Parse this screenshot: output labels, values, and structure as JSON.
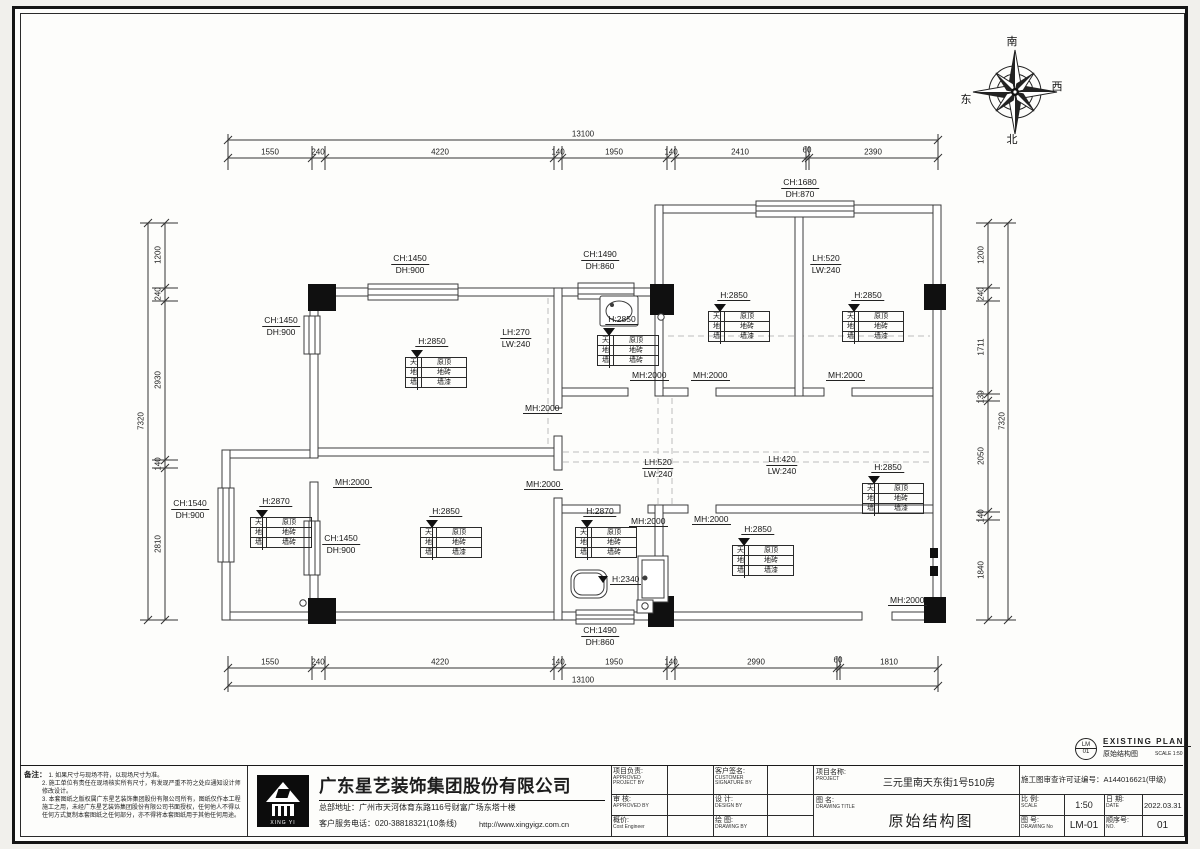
{
  "compass": {
    "south": "南",
    "west": "西",
    "east": "东",
    "north": "北"
  },
  "stamp": {
    "code_top": "LM",
    "code_bottom": "01",
    "title_en": "EXISTING PLAN",
    "title_cn": "原始结构图",
    "scale": "SCALE 1:50"
  },
  "notes": {
    "label": "备注：",
    "items": [
      "1. 如果尺寸与现场不符，以现场尺寸为准。",
      "2. 施工单位有责任在现场核实所有尺寸，有发现严重不符之处应通知设计师修改设计。",
      "3. 本套图纸之版权属广东星艺装饰集团股份有限公司所有，图纸仅作本工程施工之用，未经广东星艺装饰集团股份有限公司书面授权，任何他人不得以任何方式复制本套图纸之任何部分，亦不得将本套图纸用于其他任何用途。"
    ]
  },
  "company": {
    "name": "广东星艺装饰集团股份有限公司",
    "address": "总部地址：广州市天河体育东路116号财富广场东塔十楼",
    "tel": "客户服务电话：020-38818321(10条线)",
    "url": "http://www.xingyigz.com.cn",
    "logo_label": "XING YI"
  },
  "titleblock": {
    "pm_cn": "项目负责:",
    "pm_en": "APPROVED PROJECT BY",
    "customer_cn": "客户签名:",
    "customer_en": "CUSTOMER SIGNATURE BY",
    "check_cn": "审 核:",
    "check_en": "APPROVED BY",
    "design_cn": "设 计:",
    "design_en": "DESIGN BY",
    "cost_cn": "概价:",
    "cost_en": "Cost Engineer",
    "draw_cn": "绘 图:",
    "draw_en": "DRAWING BY",
    "project_cn": "项目名称:",
    "project_en": "PROJECT",
    "project_value": "三元里南天东街1号510房",
    "license": "施工图审查许可证编号：A144016621(甲级)",
    "title_cn": "图 名:",
    "title_en": "DRAWING  TITLE",
    "title_value": "原始结构图",
    "scale_cn": "比 例:",
    "scale_en": "SCALE",
    "scale_value": "1:50",
    "date_cn": "日 期:",
    "date_en": "DATE",
    "date_value": "2022.03.31",
    "drawno_cn": "图 号:",
    "drawno_en": "DRAWING No",
    "drawno_value": "LM-01",
    "seq_cn": "顺序号:",
    "seq_en": "NO.",
    "seq_value": "01"
  },
  "plan": {
    "dim_labels": [
      {
        "t": "13100",
        "x": 583,
        "y": 134,
        "r": 0
      },
      {
        "t": "1550",
        "x": 270,
        "y": 152,
        "r": 0
      },
      {
        "t": "240",
        "x": 318,
        "y": 152,
        "r": 0
      },
      {
        "t": "4220",
        "x": 440,
        "y": 152,
        "r": 0
      },
      {
        "t": "140",
        "x": 558,
        "y": 152,
        "r": 0
      },
      {
        "t": "1950",
        "x": 614,
        "y": 152,
        "r": 0
      },
      {
        "t": "140",
        "x": 671,
        "y": 152,
        "r": 0
      },
      {
        "t": "2410",
        "x": 740,
        "y": 152,
        "r": 0
      },
      {
        "t": "60",
        "x": 807,
        "y": 150,
        "r": 0
      },
      {
        "t": "2390",
        "x": 873,
        "y": 152,
        "r": 0
      },
      {
        "t": "1550",
        "x": 270,
        "y": 662,
        "r": 0
      },
      {
        "t": "240",
        "x": 318,
        "y": 662,
        "r": 0
      },
      {
        "t": "4220",
        "x": 440,
        "y": 662,
        "r": 0
      },
      {
        "t": "140",
        "x": 558,
        "y": 662,
        "r": 0
      },
      {
        "t": "1950",
        "x": 614,
        "y": 662,
        "r": 0
      },
      {
        "t": "140",
        "x": 671,
        "y": 662,
        "r": 0
      },
      {
        "t": "2990",
        "x": 756,
        "y": 662,
        "r": 0
      },
      {
        "t": "60",
        "x": 838,
        "y": 660,
        "r": 0
      },
      {
        "t": "1810",
        "x": 889,
        "y": 662,
        "r": 0
      },
      {
        "t": "13100",
        "x": 583,
        "y": 680,
        "r": 0
      },
      {
        "t": "1200",
        "x": 158,
        "y": 255,
        "r": 1
      },
      {
        "t": "240",
        "x": 158,
        "y": 294,
        "r": 1
      },
      {
        "t": "2930",
        "x": 158,
        "y": 380,
        "r": 1
      },
      {
        "t": "140",
        "x": 158,
        "y": 464,
        "r": 1
      },
      {
        "t": "2810",
        "x": 158,
        "y": 544,
        "r": 1
      },
      {
        "t": "7320",
        "x": 141,
        "y": 421,
        "r": 1
      },
      {
        "t": "1200",
        "x": 981,
        "y": 255,
        "r": 1
      },
      {
        "t": "240",
        "x": 981,
        "y": 294,
        "r": 1
      },
      {
        "t": "1711",
        "x": 981,
        "y": 347,
        "r": 1
      },
      {
        "t": "139",
        "x": 981,
        "y": 397,
        "r": 1
      },
      {
        "t": "2050",
        "x": 981,
        "y": 456,
        "r": 1
      },
      {
        "t": "140",
        "x": 981,
        "y": 516,
        "r": 1
      },
      {
        "t": "1840",
        "x": 981,
        "y": 570,
        "r": 1
      },
      {
        "t": "7320",
        "x": 1002,
        "y": 421,
        "r": 1
      }
    ],
    "wall_labels": [
      {
        "l1": "CH:1680",
        "l2": "DH:870",
        "x": 800,
        "y": 177
      },
      {
        "l1": "CH:1450",
        "l2": "DH:900",
        "x": 410,
        "y": 253
      },
      {
        "l1": "CH:1490",
        "l2": "DH:860",
        "x": 600,
        "y": 249
      },
      {
        "l1": "LH:520",
        "l2": "LW:240",
        "x": 826,
        "y": 253
      },
      {
        "l1": "CH:1450",
        "l2": "DH:900",
        "x": 281,
        "y": 315
      },
      {
        "l1": "LH:270",
        "l2": "LW:240",
        "x": 516,
        "y": 327
      },
      {
        "l1": "CH:1540",
        "l2": "DH:900",
        "x": 190,
        "y": 498
      },
      {
        "l1": "CH:1450",
        "l2": "DH:900",
        "x": 341,
        "y": 533
      },
      {
        "l1": "LH:520",
        "l2": "LW:240",
        "x": 658,
        "y": 457
      },
      {
        "l1": "LH:420",
        "l2": "LW:240",
        "x": 782,
        "y": 454
      },
      {
        "l1": "CH:1490",
        "l2": "DH:860",
        "x": 600,
        "y": 625
      }
    ],
    "mh_labels": [
      {
        "t": "MH:2000",
        "x": 523,
        "y": 403
      },
      {
        "t": "MH:2000",
        "x": 630,
        "y": 370
      },
      {
        "t": "MH:2000",
        "x": 691,
        "y": 370
      },
      {
        "t": "MH:2000",
        "x": 826,
        "y": 370
      },
      {
        "t": "MH:2000",
        "x": 333,
        "y": 477
      },
      {
        "t": "MH:2000",
        "x": 524,
        "y": 479
      },
      {
        "t": "MH:2000",
        "x": 629,
        "y": 516
      },
      {
        "t": "MH:2000",
        "x": 692,
        "y": 514
      },
      {
        "t": "MH:2000",
        "x": 888,
        "y": 595
      }
    ],
    "tags": [
      {
        "h": "H:2850",
        "hx": 432,
        "hy": 347,
        "tx": 405,
        "ty": 357,
        "rows": [
          [
            "天",
            "原顶"
          ],
          [
            "地",
            "地砖"
          ],
          [
            "墙",
            "墙漆"
          ]
        ]
      },
      {
        "h": "H:2850",
        "hx": 622,
        "hy": 325,
        "tx": 597,
        "ty": 335,
        "rows": [
          [
            "天",
            "原顶"
          ],
          [
            "地",
            "地砖"
          ],
          [
            "墙",
            "墙砖"
          ]
        ]
      },
      {
        "h": "H:2850",
        "hx": 734,
        "hy": 301,
        "tx": 708,
        "ty": 311,
        "rows": [
          [
            "天",
            "原顶"
          ],
          [
            "地",
            "地砖"
          ],
          [
            "墙",
            "墙漆"
          ]
        ]
      },
      {
        "h": "H:2850",
        "hx": 868,
        "hy": 301,
        "tx": 842,
        "ty": 311,
        "rows": [
          [
            "天",
            "原顶"
          ],
          [
            "地",
            "地砖"
          ],
          [
            "墙",
            "墙漆"
          ]
        ]
      },
      {
        "h": "H:2870",
        "hx": 276,
        "hy": 507,
        "tx": 250,
        "ty": 517,
        "rows": [
          [
            "天",
            "原顶"
          ],
          [
            "地",
            "地砖"
          ],
          [
            "墙",
            "墙砖"
          ]
        ]
      },
      {
        "h": "H:2850",
        "hx": 446,
        "hy": 517,
        "tx": 420,
        "ty": 527,
        "rows": [
          [
            "天",
            "原顶"
          ],
          [
            "地",
            "地砖"
          ],
          [
            "墙",
            "墙漆"
          ]
        ]
      },
      {
        "h": "H:2870",
        "hx": 600,
        "hy": 517,
        "tx": 575,
        "ty": 527,
        "rows": [
          [
            "天",
            "原顶"
          ],
          [
            "地",
            "地砖"
          ],
          [
            "墙",
            "墙砖"
          ]
        ]
      },
      {
        "h": "H:2850",
        "hx": 758,
        "hy": 535,
        "tx": 732,
        "ty": 545,
        "rows": [
          [
            "天",
            "原顶"
          ],
          [
            "地",
            "地砖"
          ],
          [
            "墙",
            "墙漆"
          ]
        ]
      },
      {
        "h": "H:2850",
        "hx": 888,
        "hy": 473,
        "tx": 862,
        "ty": 483,
        "rows": [
          [
            "天",
            "原顶"
          ],
          [
            "地",
            "地砖"
          ],
          [
            "墙",
            "墙漆"
          ]
        ]
      }
    ],
    "extra_labels": [
      {
        "t": "H:2340",
        "x": 610,
        "y": 574
      }
    ]
  }
}
